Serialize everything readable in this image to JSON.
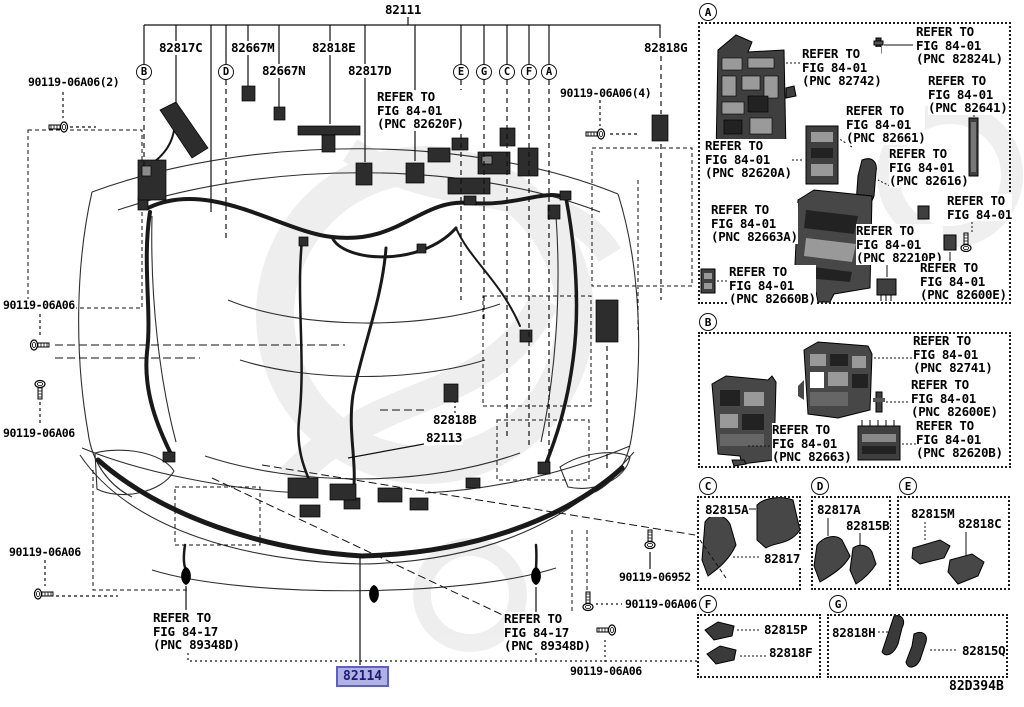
{
  "drawing": {
    "code": "82D394B"
  },
  "main": {
    "root_part": "82111",
    "parts": {
      "p82817C": "82817C",
      "p82667M": "82667M",
      "p82818E": "82818E",
      "p82667N": "82667N",
      "p82817D": "82817D",
      "p82818G": "82818G",
      "p82818B": "82818B",
      "p82113": "82113"
    },
    "highlighted_part": {
      "number": "82114",
      "bg": "#b0b1e4",
      "border": "#5e5ec9",
      "color": "#1c1c74"
    },
    "fasteners": {
      "top_left": "90119-06A06(2)",
      "top_right": "90119-06A06(4)",
      "left_upper": "90119-06A06",
      "left_mid": "90119-06A06",
      "left_lower": "90119-06A06",
      "bottom_06952": "90119-06952",
      "bottom_right_upper": "90119-06A06",
      "bottom_right_lower": "90119-06A06"
    },
    "callouts": {
      "b": "B",
      "d": "D",
      "e": "E",
      "g": "G",
      "c": "C",
      "f": "F",
      "a": "A"
    },
    "refs": {
      "pnc_82620F": [
        "REFER TO",
        "FIG 84-01",
        "(PNC 82620F)"
      ],
      "pnc_89348D_left": [
        "REFER TO",
        "FIG 84-17",
        "(PNC 89348D)"
      ],
      "pnc_89348D_right": [
        "REFER TO",
        "FIG 84-17",
        "(PNC 89348D)"
      ]
    }
  },
  "panels": {
    "A": {
      "letter": "A",
      "refs": [
        [
          "REFER TO",
          "FIG 84-01",
          "(PNC 82742)"
        ],
        [
          "REFER TO",
          "FIG 84-01",
          "(PNC 82824L)"
        ],
        [
          "REFER TO",
          "FIG 84-01",
          "(PNC 82641)"
        ],
        [
          "REFER TO",
          "FIG 84-01",
          "(PNC 82661)"
        ],
        [
          "REFER TO",
          "FIG 84-01",
          "(PNC 82620A)"
        ],
        [
          "REFER TO",
          "FIG 84-01",
          "(PNC 82616)"
        ],
        [
          "REFER TO",
          "FIG 84-01",
          "(PNC 82663A)"
        ],
        [
          "REFER TO",
          "FIG 84-01"
        ],
        [
          "REFER TO",
          "FIG 84-01",
          "(PNC 82210P)"
        ],
        [
          "REFER TO",
          "FIG 84-01",
          "(PNC 82660B)"
        ],
        [
          "REFER TO",
          "FIG 84-01",
          "(PNC 82600E)"
        ]
      ]
    },
    "B": {
      "letter": "B",
      "refs": [
        [
          "REFER TO",
          "FIG 84-01",
          "(PNC 82741)"
        ],
        [
          "REFER TO",
          "FIG 84-01",
          "(PNC 82600E)"
        ],
        [
          "REFER TO",
          "FIG 84-01",
          "(PNC 82663)"
        ],
        [
          "REFER TO",
          "FIG 84-01",
          "(PNC 82620B)"
        ]
      ]
    },
    "C": {
      "letter": "C",
      "parts": [
        "82815A",
        "82817"
      ]
    },
    "D": {
      "letter": "D",
      "parts": [
        "82817A",
        "82815B"
      ]
    },
    "E": {
      "letter": "E",
      "parts": [
        "82815M",
        "82818C"
      ]
    },
    "F": {
      "letter": "F",
      "parts": [
        "82815P",
        "82818F"
      ]
    },
    "G": {
      "letter": "G",
      "parts": [
        "82818H",
        "82815Q"
      ]
    }
  }
}
